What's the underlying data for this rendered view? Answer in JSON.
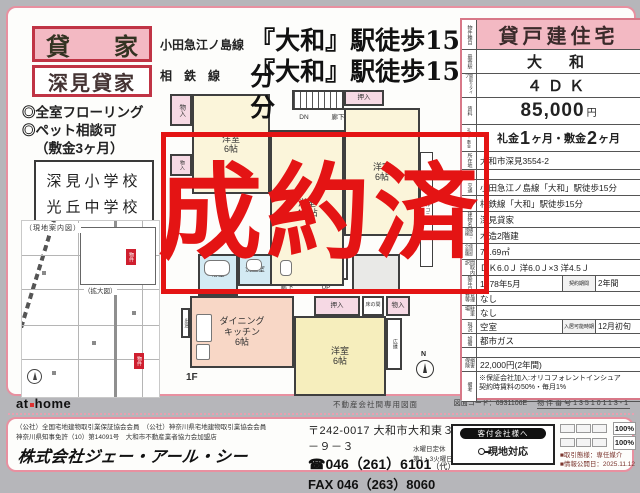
{
  "colors": {
    "accent_pink": "#e890a0",
    "fill_pink": "#f3b9c3",
    "dark_red": "#c03445",
    "stamp_red": "#e41414"
  },
  "left": {
    "badge": "貸　家",
    "house_name": "深見貸家",
    "features": [
      "◎全室フローリング",
      "◎ペット相談可",
      "（敷金3ヶ月）"
    ],
    "schools": [
      "深見小学校",
      "光丘中学校"
    ]
  },
  "access": [
    {
      "line": "小田急江ノ島線",
      "walk": "『大和』駅徒歩15分"
    },
    {
      "line": "相　鉄　線",
      "walk": "『大和』駅徒歩15分"
    }
  ],
  "map": {
    "title": "（現地案内図）",
    "enlarged": "（拡大図）",
    "marker_label": "物件",
    "compass": "N"
  },
  "stamp": {
    "text": "成約済"
  },
  "floorplan": {
    "floor1_label": "1F",
    "compass": "N",
    "rooms": [
      {
        "name": "room-storage-2f",
        "label": "物入",
        "x": 12,
        "y": 8,
        "w": 22,
        "h": 32,
        "cls": "closet",
        "vert": true,
        "small": true
      },
      {
        "name": "room-storage-2f",
        "label": "物入",
        "x": 12,
        "y": 68,
        "w": 22,
        "h": 22,
        "cls": "closet",
        "vert": true,
        "tiny": true
      },
      {
        "name": "room-western-6-2f",
        "label": "洋室\n6帖",
        "x": 34,
        "y": 8,
        "w": 78,
        "h": 100,
        "cls": "cream"
      },
      {
        "name": "stairs-down",
        "label": "",
        "x": 134,
        "y": 4,
        "w": 52,
        "h": 20,
        "cls": "stairs"
      },
      {
        "name": "stairs-dn-label",
        "label": "DN",
        "x": 134,
        "y": 26,
        "w": 24,
        "h": 11,
        "cls": "noborder",
        "small": true
      },
      {
        "name": "hallway-2f",
        "label": "廊下",
        "x": 160,
        "y": 26,
        "w": 40,
        "h": 11,
        "cls": "noborder",
        "small": true
      },
      {
        "name": "closet-oshiire-2f",
        "label": "押入",
        "x": 186,
        "y": 4,
        "w": 40,
        "h": 16,
        "cls": "closet",
        "small": true
      },
      {
        "name": "room-western-6b-2f",
        "label": "洋室\n6帖",
        "x": 186,
        "y": 22,
        "w": 76,
        "h": 128,
        "cls": "cream"
      },
      {
        "name": "room-western-45-2f",
        "label": "洋室\n4.5帖",
        "x": 112,
        "y": 44,
        "w": 74,
        "h": 156,
        "cls": "cream"
      },
      {
        "name": "balcony",
        "label": "バルコニー",
        "x": 262,
        "y": 66,
        "w": 13,
        "h": 115,
        "cls": "balcony",
        "vert": true,
        "tiny": true
      },
      {
        "name": "bathroom",
        "label": "浴室",
        "x": 40,
        "y": 168,
        "w": 40,
        "h": 42,
        "cls": "blue",
        "small": true
      },
      {
        "name": "washroom",
        "label": "洗面室",
        "x": 80,
        "y": 168,
        "w": 34,
        "h": 32,
        "cls": "blue",
        "small": true
      },
      {
        "name": "toilet",
        "label": "トイレ",
        "x": 114,
        "y": 168,
        "w": 30,
        "h": 26,
        "cls": "",
        "vert": true,
        "tiny": true
      },
      {
        "name": "stairs-up",
        "label": "",
        "x": 146,
        "y": 168,
        "w": 44,
        "h": 26,
        "cls": "stairs"
      },
      {
        "name": "stairs-up-label",
        "label": "UP",
        "x": 146,
        "y": 196,
        "w": 44,
        "h": 11,
        "cls": "noborder",
        "small": true
      },
      {
        "name": "hallway-1f",
        "label": "廊下",
        "x": 114,
        "y": 196,
        "w": 30,
        "h": 11,
        "cls": "noborder",
        "small": true
      },
      {
        "name": "entrance",
        "label": "",
        "x": 194,
        "y": 168,
        "w": 48,
        "h": 40,
        "cls": "genkan"
      },
      {
        "name": "dining-kitchen",
        "label": "ダイニング\nキッチン\n6帖",
        "x": 32,
        "y": 210,
        "w": 104,
        "h": 72,
        "cls": "dk"
      },
      {
        "name": "bay-window",
        "label": "出窓",
        "x": 23,
        "y": 222,
        "w": 9,
        "h": 30,
        "cls": "",
        "vert": true,
        "tiny": true
      },
      {
        "name": "closet-oshiire-1f",
        "label": "押入",
        "x": 156,
        "y": 210,
        "w": 46,
        "h": 20,
        "cls": "closet",
        "small": true
      },
      {
        "name": "tokonoma-alcove",
        "label": "床の間",
        "x": 204,
        "y": 210,
        "w": 22,
        "h": 20,
        "cls": "",
        "tiny": true
      },
      {
        "name": "closet-mono-1f",
        "label": "物入",
        "x": 228,
        "y": 210,
        "w": 24,
        "h": 20,
        "cls": "closet",
        "small": true
      },
      {
        "name": "room-western-6-1f",
        "label": "洋室\n6帖",
        "x": 136,
        "y": 230,
        "w": 92,
        "h": 80,
        "cls": "yellow"
      },
      {
        "name": "veranda-hiroen",
        "label": "広縁",
        "x": 228,
        "y": 232,
        "w": 16,
        "h": 52,
        "cls": "",
        "vert": true,
        "tiny": true
      }
    ]
  },
  "panel": {
    "rows": [
      {
        "type": "header",
        "label": "物件種目",
        "value": "貸戸建住宅",
        "h": 30
      },
      {
        "type": "center",
        "label": "最寄駅",
        "value": "大　和",
        "h": 24
      },
      {
        "type": "center",
        "label": "間取りタイプ",
        "value": "４ＤＫ",
        "h": 24
      },
      {
        "type": "rent",
        "label": "賃料",
        "value": "85,000",
        "unit": "円",
        "h": 27
      },
      {
        "type": "reikin",
        "label": "礼金・敷金",
        "parts": [
          "礼金",
          "1",
          "ヶ月・敷金",
          "2",
          "ヶ月"
        ],
        "h": 27
      },
      {
        "type": "left",
        "label": "所在地",
        "value": "大和市深見3554-2",
        "h": 18
      },
      {
        "type": "blank",
        "label": "",
        "value": "",
        "h": 10
      },
      {
        "type": "left",
        "label": "交通",
        "value": "小田急江ノ島線「大和」駅徒歩15分",
        "h": 16
      },
      {
        "type": "left",
        "label": "",
        "value": "相鉄線「大和」駅徒歩15分",
        "h": 16
      },
      {
        "type": "left",
        "label": "建物名",
        "value": "深見貸家",
        "h": 16
      },
      {
        "type": "left",
        "label": "構造・規模",
        "value": "木造2階建",
        "h": 16
      },
      {
        "type": "left",
        "label": "使用部分面積",
        "value": "73.69㎡",
        "h": 16
      },
      {
        "type": "left",
        "label": "間取内訳",
        "value": "ＤＫ6.0Ｊ 洋6.0Ｊ×3 洋4.5Ｊ",
        "h": 16
      },
      {
        "type": "split",
        "label": "築年月",
        "value": "1978年5月",
        "label2": "契約期間",
        "value2": "2年間",
        "h": 16
      },
      {
        "type": "left",
        "label": "管理費等",
        "value": "なし",
        "h": 14
      },
      {
        "type": "left",
        "label": "駐車場",
        "value": "なし",
        "h": 14
      },
      {
        "type": "split",
        "label": "現況",
        "value": "空室",
        "label2": "入居可能時期",
        "value2": "12月初旬",
        "h": 14
      },
      {
        "type": "left",
        "label": "設備",
        "value": "都市ガス",
        "h": 14
      },
      {
        "type": "blank",
        "label": "",
        "value": "",
        "h": 10
      },
      {
        "type": "left",
        "label": "損害保険",
        "value": "22,000円(2年間)",
        "h": 14
      },
      {
        "type": "note",
        "label": "備考",
        "value": "※保証会社加入:オリコフォレントインシュア\n契約時賃料の50%・毎月1%",
        "h": 30
      }
    ]
  },
  "bar": {
    "logo_at": "at",
    "logo_home": "home",
    "caption": "不動産会社間専用図面",
    "zumen_code": "図面コード：6931106E",
    "bukken_no": "物件番号13510113-1"
  },
  "footer": {
    "memberships": [
      "（公社）全国宅地建物取引業保証協会会員　（公社）神奈川県宅地建物取引業協会会員",
      "神奈川県知事免許（10）第14091号　大和市不動産業者協力会加盟店"
    ],
    "company": "株式会社ジェー・アール・シー",
    "postal": "〒242-0017 大和市大和東３－９－３",
    "tel": "046（261）6101",
    "tel_suffix": "（代）",
    "fax": "FAX 046（263）8060",
    "holiday1": "水曜日定休",
    "holiday2": "第1・3火曜日",
    "agent_box": {
      "header": "客付会社様へ",
      "note": "現地対応"
    },
    "info_box": {
      "fees": [
        "100%",
        "100%"
      ],
      "torihiki": "■取引態様：専任媒介",
      "publish": "■情報公開日：2025.11.12"
    }
  }
}
